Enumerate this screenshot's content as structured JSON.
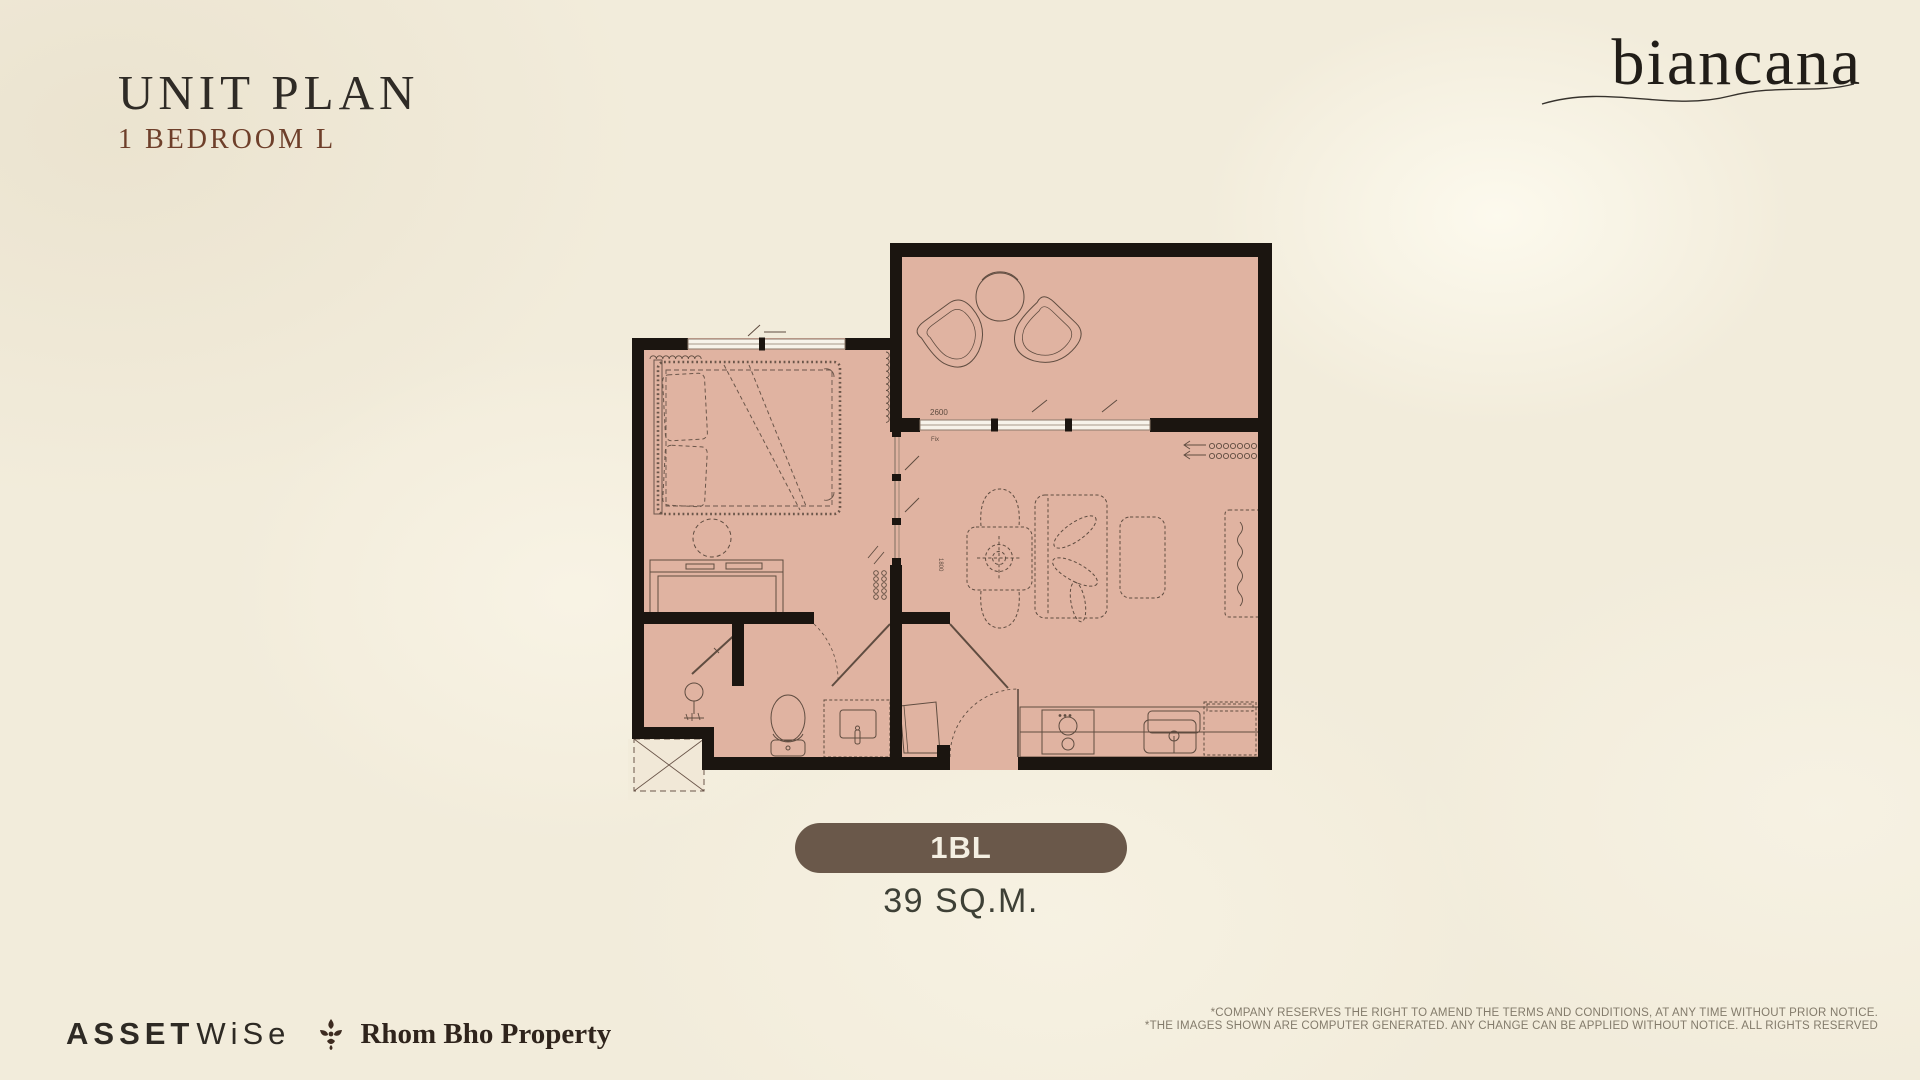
{
  "header": {
    "title": "UNIT PLAN",
    "subtitle": "1 BEDROOM L",
    "brand": "biancana"
  },
  "unit": {
    "code": "1BL",
    "area": "39 SQ.M.",
    "badge_color": "#6a584a"
  },
  "floorplan": {
    "room_fill": "#e0b3a1",
    "wall_color": "#1b1510",
    "line_color": "#5f4c40",
    "labels": {
      "balcony_width": "2600",
      "fixed_glass": "Fix",
      "partition_dim": "1800"
    }
  },
  "footer": {
    "assetwise_1": "ASSET",
    "assetwise_2": "WiSe",
    "rhombho": "Rhom Bho Property",
    "disclaimer_line1": "*COMPANY RESERVES THE RIGHT TO AMEND THE TERMS AND CONDITIONS, AT ANY TIME WITHOUT PRIOR NOTICE.",
    "disclaimer_line2": "*THE IMAGES SHOWN ARE COMPUTER GENERATED. ANY CHANGE CAN BE APPLIED WITHOUT NOTICE. ALL RIGHTS RESERVED"
  }
}
